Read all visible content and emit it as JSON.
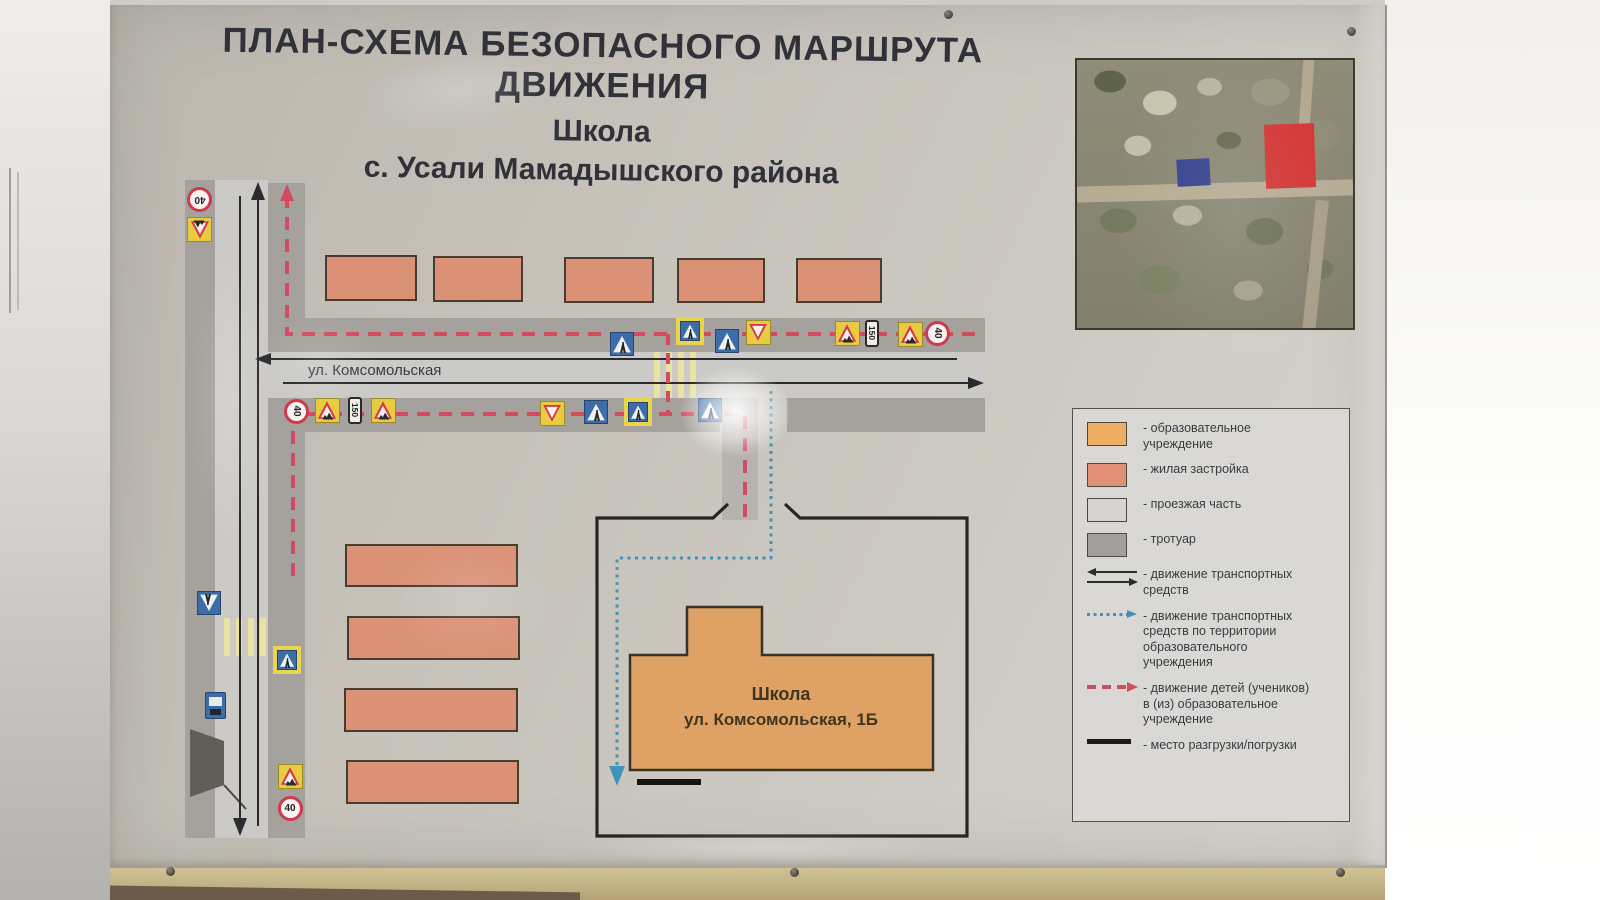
{
  "poster": {
    "title_line1": "ПЛАН-СХЕМА БЕЗОПАСНОГО МАРШРУТА ДВИЖЕНИЯ",
    "title_line2": "Школа",
    "title_line3": "с. Усали Мамадышского района"
  },
  "map": {
    "street_label": "ул. Комсомольская",
    "school_label_line1": "Школа",
    "school_label_line2": "ул. Комсомольская, 1Б",
    "sign_text": {
      "speed_limit": "40",
      "distance_plate": "150"
    },
    "signs": [
      {
        "type": "speed40",
        "x": 200,
        "y": 200,
        "rot": 180
      },
      {
        "type": "children",
        "x": 200,
        "y": 230,
        "rot": 180
      },
      {
        "type": "pedinfo",
        "x": 622,
        "y": 344,
        "rot": 0
      },
      {
        "type": "pedcross",
        "x": 690,
        "y": 331,
        "rot": 0
      },
      {
        "type": "pedinfo",
        "x": 727,
        "y": 341,
        "rot": 0
      },
      {
        "type": "yield",
        "x": 758,
        "y": 332,
        "rot": 0
      },
      {
        "type": "children",
        "x": 847,
        "y": 333,
        "rot": 0
      },
      {
        "type": "plate150",
        "x": 872,
        "y": 333,
        "rot": 90
      },
      {
        "type": "children",
        "x": 910,
        "y": 334,
        "rot": 0
      },
      {
        "type": "speed40",
        "x": 938,
        "y": 333,
        "rot": 90
      },
      {
        "type": "speed40",
        "x": 297,
        "y": 411,
        "rot": 90
      },
      {
        "type": "children",
        "x": 327,
        "y": 410,
        "rot": 0
      },
      {
        "type": "plate150",
        "x": 355,
        "y": 410,
        "rot": 90
      },
      {
        "type": "children",
        "x": 383,
        "y": 410,
        "rot": 0
      },
      {
        "type": "yield",
        "x": 552,
        "y": 413,
        "rot": 0
      },
      {
        "type": "pedinfo",
        "x": 596,
        "y": 412,
        "rot": 0
      },
      {
        "type": "pedcross",
        "x": 638,
        "y": 412,
        "rot": 0
      },
      {
        "type": "pedinfo",
        "x": 710,
        "y": 410,
        "rot": 0
      },
      {
        "type": "pedinfo",
        "x": 209,
        "y": 603,
        "rot": 180
      },
      {
        "type": "pedcross",
        "x": 287,
        "y": 660,
        "rot": 0
      },
      {
        "type": "busstop",
        "x": 215,
        "y": 705,
        "rot": 0
      },
      {
        "type": "children",
        "x": 290,
        "y": 776,
        "rot": 0
      },
      {
        "type": "speed40",
        "x": 290,
        "y": 808,
        "rot": 0
      }
    ],
    "residential_buildings_top": [
      {
        "x": 325,
        "y": 255,
        "w": 92,
        "h": 46
      },
      {
        "x": 433,
        "y": 256,
        "w": 90,
        "h": 46
      },
      {
        "x": 564,
        "y": 257,
        "w": 90,
        "h": 46
      },
      {
        "x": 677,
        "y": 258,
        "w": 88,
        "h": 45
      },
      {
        "x": 796,
        "y": 258,
        "w": 86,
        "h": 45
      }
    ],
    "residential_buildings_left": [
      {
        "x": 345,
        "y": 544,
        "w": 173,
        "h": 43
      },
      {
        "x": 347,
        "y": 616,
        "w": 173,
        "h": 44
      },
      {
        "x": 344,
        "y": 688,
        "w": 174,
        "h": 44
      },
      {
        "x": 346,
        "y": 760,
        "w": 173,
        "h": 44
      }
    ]
  },
  "legend": {
    "items": [
      {
        "type": "swatch",
        "color": "#eeae63",
        "label": "- образовательное учреждение"
      },
      {
        "type": "swatch",
        "color": "#e29077",
        "label": "- жилая застройка"
      },
      {
        "type": "swatch",
        "color": "#d6d4d2",
        "label": "- проезжая часть"
      },
      {
        "type": "swatch",
        "color": "#a39f9c",
        "label": "- тротуар"
      },
      {
        "type": "arrows-double",
        "label": "- движение транспортных средств"
      },
      {
        "type": "arrow-dotted-blue",
        "label": "- движение транспортных средств по территории образовательного учреждения"
      },
      {
        "type": "arrow-dashed-red",
        "label": "- движение детей (учеников) в (из) образовательное учреждение"
      },
      {
        "type": "line-solid",
        "label": "- место разгрузки/погрузки"
      }
    ]
  },
  "colors": {
    "educational_building": "#eeae63",
    "residential_building": "#e29077",
    "roadway": "#d6d4d2",
    "sidewalk": "#a39f9c",
    "children_route": "#d24b5f",
    "territory_vehicle_route": "#3f93b9",
    "satellite_school_highlight": "#d33636",
    "satellite_other_highlight": "#35418f"
  }
}
